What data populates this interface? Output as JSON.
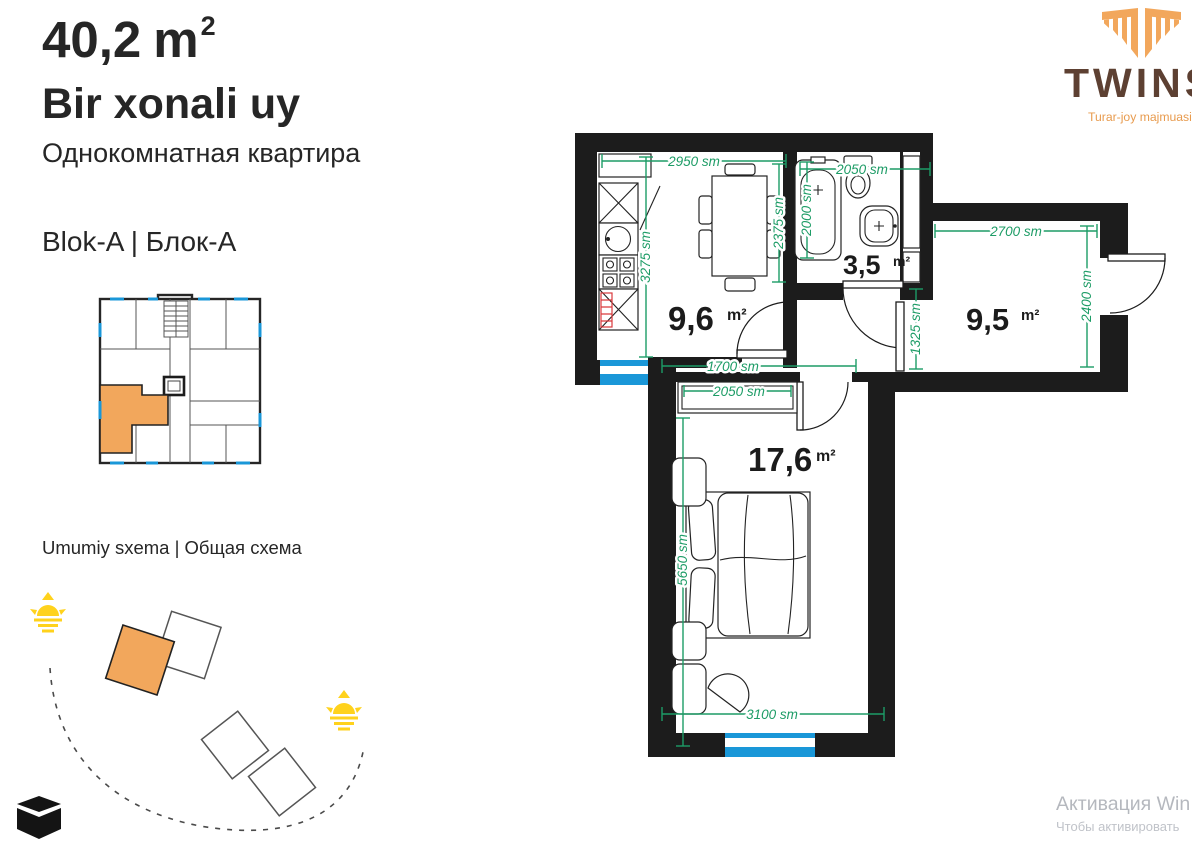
{
  "header": {
    "area_value": "40,2",
    "area_unit": "m",
    "area_sup": "2",
    "title_uz": "Bir xonali uy",
    "title_ru": "Однокомнатная квартира",
    "block_label": "Blok-A | Блок-А",
    "scheme_label": "Umumiy sxema | Общая схема"
  },
  "logo": {
    "name": "TWINS",
    "tagline": "Turar-joy majmuasi"
  },
  "plan": {
    "rooms": {
      "kitchen": {
        "area": "9,6",
        "unit": "m²"
      },
      "bathroom": {
        "area": "3,5",
        "unit": "m²"
      },
      "hall_room": {
        "area": "9,5",
        "unit": "m²"
      },
      "bedroom": {
        "area": "17,6",
        "unit": "m²"
      }
    },
    "dimensions": {
      "kitchen_width": "2950 sm",
      "bathroom_width": "2050 sm",
      "kitchen_depth": "3275 sm",
      "kitchen_inner": "2375 sm",
      "bathroom_depth": "2000 sm",
      "room_width": "2700 sm",
      "room_depth": "2400 sm",
      "hall_depth": "1325 sm",
      "hall_width": "1700 sm",
      "wardrobe_width": "2050 sm",
      "bedroom_width": "3100 sm",
      "bedroom_depth": "5650 sm"
    }
  },
  "watermark": {
    "line1": "Активация Win",
    "line2": "Чтобы активировать"
  },
  "colors": {
    "wall": "#1c1c1c",
    "dim": "#1d9c66",
    "win": "#1a97d8",
    "accent": "#f2a75c",
    "sun": "#ffd21c",
    "logo_text": "#5d4032",
    "logo_accent": "#e89b4e",
    "radiator": "#d93a3c",
    "watermark": "#b5b8be"
  }
}
